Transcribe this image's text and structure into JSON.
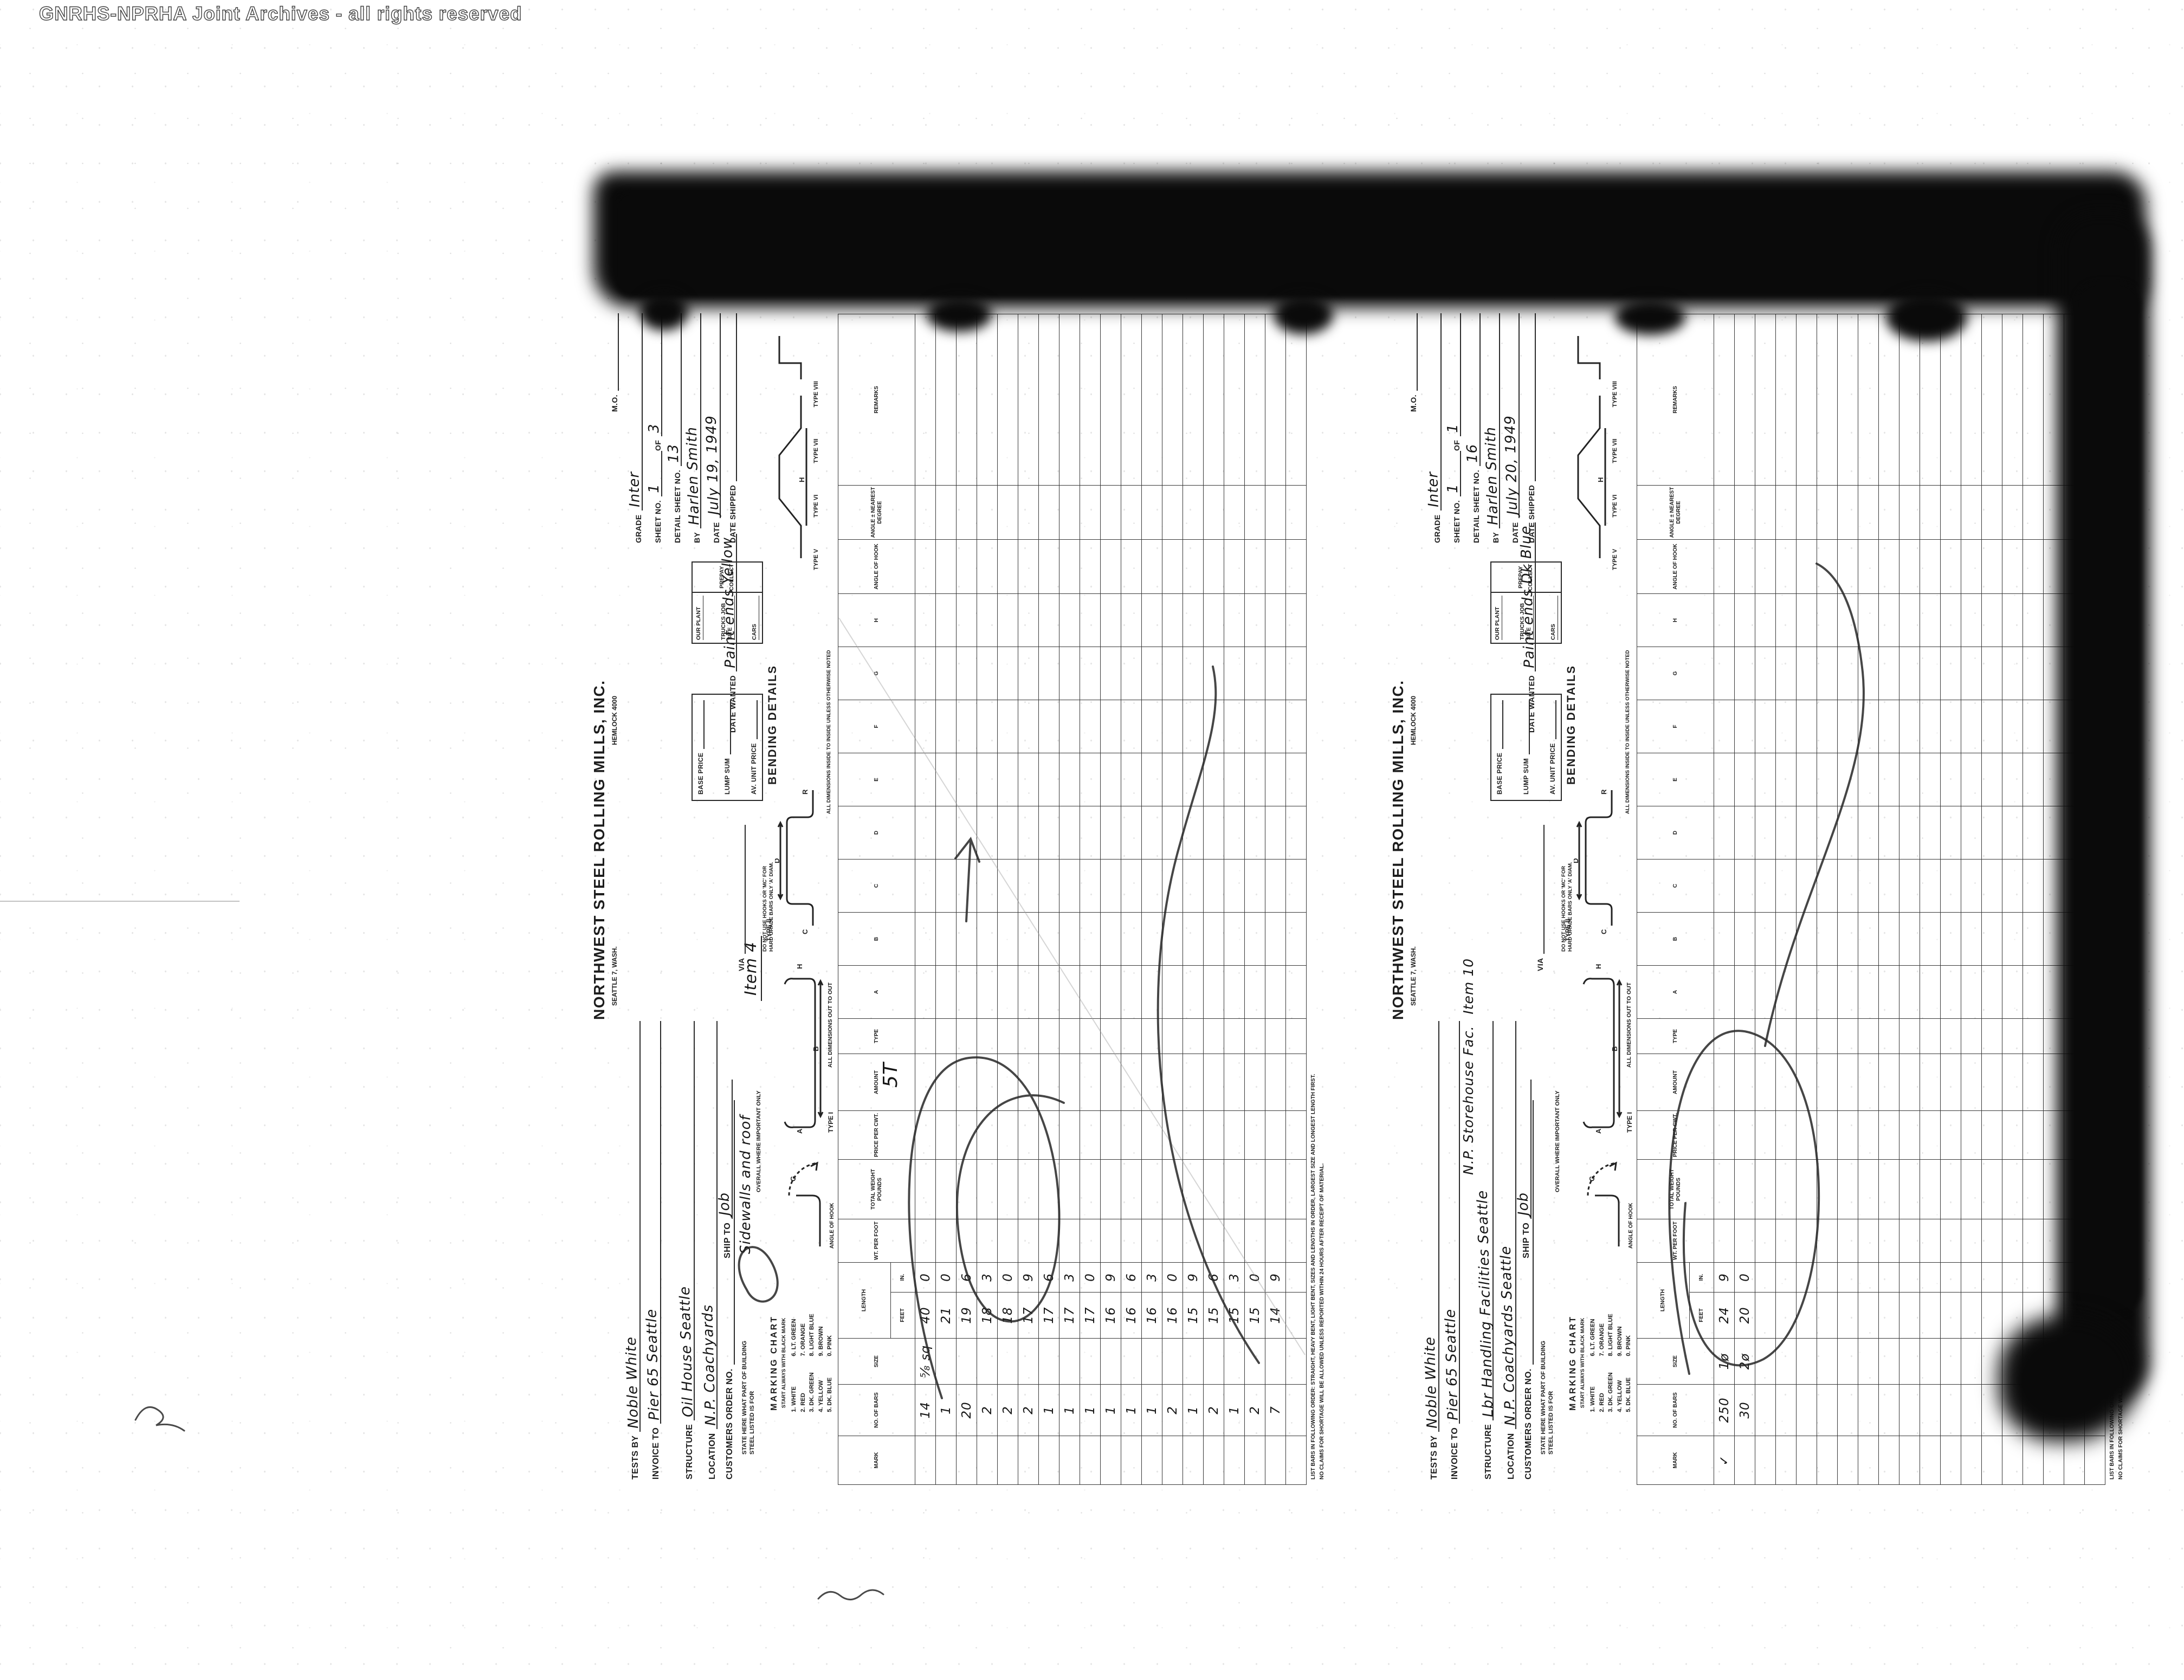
{
  "watermark": "GNRHS-NPRHA Joint Archives - all rights reserved",
  "colors": {
    "paper": "#ffffff",
    "ink": "#1d1d1d",
    "pencil": "#2b2b2b",
    "toner": "#0a0a0a",
    "watermark_gray": "#3e3e3e"
  },
  "form_labels": {
    "company": {
      "name": "NORTHWEST STEEL ROLLING MILLS, INC.",
      "city": "SEATTLE 7, WASH.",
      "phone": "HEMLOCK 4000"
    },
    "fields": {
      "tests_by": "TESTS BY",
      "invoice_to": "INVOICE TO",
      "structure": "STRUCTURE",
      "location": "LOCATION",
      "customers_order": "CUSTOMERS ORDER NO.",
      "state_here": "STATE HERE WHAT PART OF BUILDING STEEL LISTED IS FOR",
      "ship_to": "SHIP TO",
      "mo": "M.O.",
      "grade": "GRADE",
      "sheet_no": "SHEET NO.",
      "of": "OF",
      "detail_sheet_no": "DETAIL SHEET NO.",
      "by": "BY",
      "date": "DATE",
      "date_shipped": "DATE SHIPPED",
      "our_plant": "OUR PLANT",
      "trucks_job_site": "TRUCKS JOB SITE",
      "cars": "CARS",
      "prepay": "PREPAY",
      "collect": "COLLECT",
      "base_price": "BASE PRICE",
      "lump_sum": "LUMP SUM",
      "av_unit_price": "AV. UNIT PRICE",
      "via": "VIA",
      "date_wanted": "DATE WANTED",
      "bending_details": "BENDING DETAILS"
    },
    "marking": {
      "title": "MARKING CHART",
      "subtitle": "START ALWAYS WITH BLACK MARK",
      "col1": [
        "1. WHITE",
        "2. RED",
        "3. DK. GREEN",
        "4. YELLOW",
        "5. DK. BLUE"
      ],
      "col2": [
        "6. LT. GREEN",
        "7. ORANGE",
        "8. LIGHT BLUE",
        "9. BROWN",
        "0. PINK"
      ]
    },
    "notes": {
      "hooks": "DO NOT USE HOOKS OR 'MC' FOR HARD GRADE BARS ONLY 'A' DIAM.",
      "overall": "OVERALL WHERE IMPORTANT ONLY",
      "out": "ALL DIMENSIONS OUT TO OUT",
      "inside": "ALL DIMENSIONS INSIDE TO INSIDE UNLESS OTHERWISE NOTED",
      "angle_of_hook": "ANGLE OF HOOK",
      "list_order": "LIST BARS IN FOLLOWING ORDER: STRAIGHT, HEAVY BENT, LIGHT BENT, SIZES AND LENGTHS IN ORDER, LARGEST SIZE AND LONGEST LENGTH FIRST.",
      "claims": "NO CLAIMS FOR SHORTAGE WILL BE ALLOWED UNLESS REPORTED WITHIN 24 HOURS AFTER RECEIPT OF MATERIAL."
    },
    "type_labels": [
      "TYPE I",
      "TYPE II",
      "TYPE V",
      "TYPE VI",
      "TYPE VII",
      "TYPE VIII"
    ],
    "diagram_letters": [
      "A",
      "B",
      "C",
      "D",
      "G",
      "H",
      "R"
    ],
    "columns": [
      {
        "label": "MARK"
      },
      {
        "label": "NO. OF BARS"
      },
      {
        "label": "SIZE"
      },
      {
        "group": "LENGTH",
        "children": [
          "FEET",
          "IN."
        ]
      },
      {
        "label": "WT. PER FOOT"
      },
      {
        "label": "TOTAL WEIGHT POUNDS"
      },
      {
        "label": "PRICE PER CWT."
      },
      {
        "label": "AMOUNT"
      },
      {
        "label": "TYPE"
      },
      {
        "label": "A"
      },
      {
        "label": "B"
      },
      {
        "label": "C"
      },
      {
        "label": "D"
      },
      {
        "label": "E"
      },
      {
        "label": "F"
      },
      {
        "label": "G"
      },
      {
        "label": "H"
      },
      {
        "label": "ANGLE OF HOOK"
      },
      {
        "label": "ANGLE ± NEAREST DEGREE"
      },
      {
        "label": "REMARKS"
      }
    ]
  },
  "forms": [
    {
      "tests_by": "Noble White",
      "invoice_to": "Pier 65 Seattle",
      "structure": "Oil House Seattle",
      "structure2": "",
      "location": "N.P. Coachyards",
      "customers_order": "",
      "ship_to": "Job",
      "part_note": "Sidewalls and roof",
      "grade": "Inter",
      "sheet_no": "1",
      "sheet_of": "3",
      "detail_sheet_no": "13",
      "by": "Harlen Smith",
      "date": "July 19, 1949",
      "date_shipped": "",
      "date_wanted": "Paint ends Yellow",
      "item_note": "Item 4",
      "weight_note": "5T",
      "rows": [
        {
          "mark": "",
          "bars": "14",
          "size": "⅝ sq",
          "feet": "40",
          "in": "0"
        },
        {
          "bars": "1",
          "feet": "21",
          "in": "0"
        },
        {
          "bars": "20",
          "feet": "19",
          "in": "6"
        },
        {
          "bars": "2",
          "feet": "18",
          "in": "3"
        },
        {
          "bars": "2",
          "feet": "18",
          "in": "0"
        },
        {
          "bars": "2",
          "feet": "17",
          "in": "9"
        },
        {
          "bars": "1",
          "feet": "17",
          "in": "6"
        },
        {
          "bars": "1",
          "feet": "17",
          "in": "3"
        },
        {
          "bars": "1",
          "feet": "17",
          "in": "0"
        },
        {
          "bars": "1",
          "feet": "16",
          "in": "9"
        },
        {
          "bars": "1",
          "feet": "16",
          "in": "6"
        },
        {
          "bars": "1",
          "feet": "16",
          "in": "3"
        },
        {
          "bars": "2",
          "feet": "16",
          "in": "0"
        },
        {
          "bars": "1",
          "feet": "15",
          "in": "9"
        },
        {
          "bars": "2",
          "feet": "15",
          "in": "6"
        },
        {
          "bars": "1",
          "feet": "15",
          "in": "3"
        },
        {
          "bars": "2",
          "feet": "15",
          "in": "0"
        },
        {
          "bars": "7",
          "feet": "14",
          "in": "9"
        }
      ]
    },
    {
      "tests_by": "Noble White",
      "invoice_to": "Pier 65 Seattle",
      "structure": "Lbr Handling Facilities Seattle",
      "structure2": "N.P. Storehouse Fac.",
      "location": "N.P. Coachyards Seattle",
      "customers_order": "",
      "ship_to": "Job",
      "part_note": "",
      "grade": "Inter",
      "sheet_no": "1",
      "sheet_of": "1",
      "detail_sheet_no": "16",
      "by": "Harlen Smith",
      "date": "July 20, 1949",
      "date_shipped": "",
      "date_wanted": "Paint ends Dk Blue",
      "item_note": "Item 10",
      "weight_note": "",
      "rows": [
        {
          "mark": "✓",
          "bars": "250",
          "size": "1ø",
          "feet": "24",
          "in": "9"
        },
        {
          "bars": "30",
          "size": "2ø",
          "feet": "20",
          "in": "0"
        }
      ]
    }
  ]
}
